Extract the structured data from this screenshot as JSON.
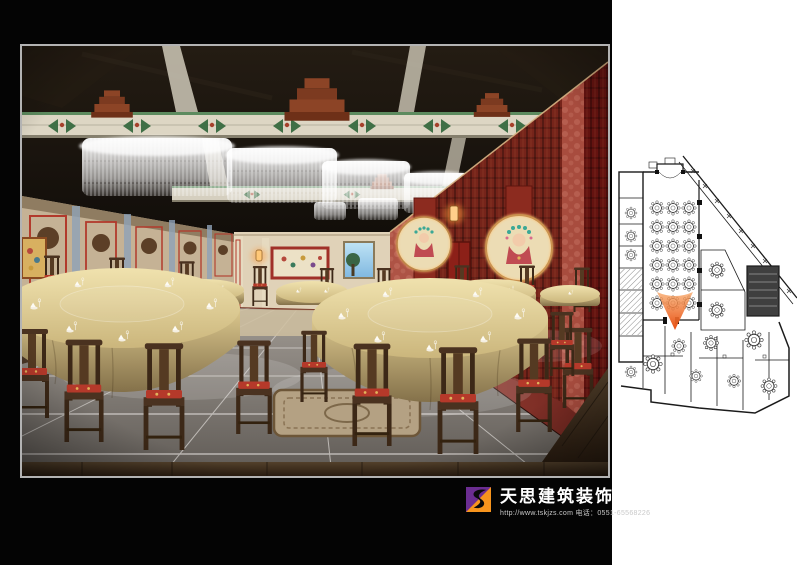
{
  "board": {
    "background_color": "#040404",
    "frame_border_color": "#b3b3b3"
  },
  "logo": {
    "company": "天思建筑装饰",
    "website": "http://www.tskjzs.com",
    "phone_label": "电话：",
    "phone": "0551-65568226",
    "icon_colors": {
      "purple": "#6b2d91",
      "orange": "#f7941d",
      "swoosh": "#0a0a0a"
    }
  },
  "floor_plan": {
    "paper_color": "#ffffff",
    "line_color": "#1b1b1b",
    "marker_color_top": "#f7a260",
    "marker_color_bottom": "#e84d10",
    "banquet_hall_table_rows": 6,
    "banquet_hall_table_cols": 3
  },
  "render": {
    "palette": {
      "ceiling": "#130e09",
      "beam_face": "#ddd6c4",
      "beam_green": "#3f6f46",
      "corbel_red": "#8c4426",
      "left_wall_tan": "#cdbb9e",
      "panel_frame_red": "#b23a2c",
      "right_wall_red": "#9c4238",
      "lattice_red": "#76241a",
      "tablecloth_gold": "#e8d8a0",
      "chair_wood": "#46301f",
      "cushion_red": "#b5392a",
      "floor_gray": "#8d8984",
      "wood_floor": "#3e2c1d",
      "chandelier_white": "#ffffff"
    }
  }
}
